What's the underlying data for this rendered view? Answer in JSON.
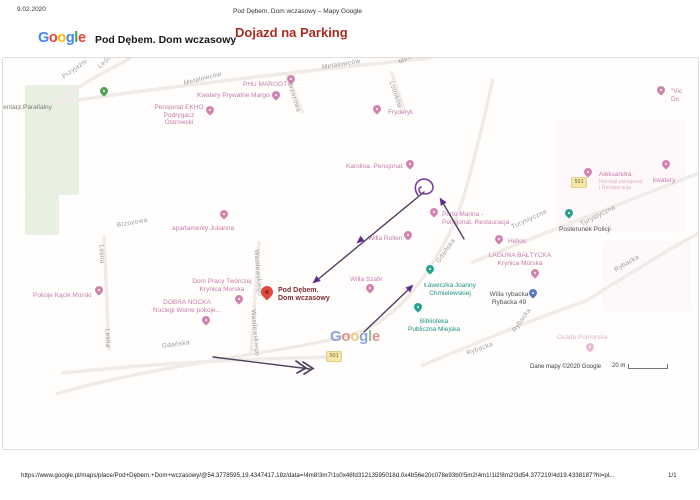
{
  "header": {
    "date": "9.02.2020",
    "doc_title": "Pod Dębem. Dom wczasowy – Mapy Google",
    "brand": "Google",
    "place_title": "Pod Dębem. Dom wczasowy",
    "heading": "Dojazd na Parking"
  },
  "google_letters": [
    {
      "ch": "G",
      "c": "#4285F4"
    },
    {
      "ch": "o",
      "c": "#EA4335"
    },
    {
      "ch": "o",
      "c": "#FBBC05"
    },
    {
      "ch": "g",
      "c": "#4285F4"
    },
    {
      "ch": "l",
      "c": "#34A853"
    },
    {
      "ch": "e",
      "c": "#EA4335"
    }
  ],
  "watermark_letters": [
    {
      "ch": "G",
      "c": "#6f8fd2"
    },
    {
      "ch": "o",
      "c": "#d77b72"
    },
    {
      "ch": "o",
      "c": "#e5c05c"
    },
    {
      "ch": "g",
      "c": "#6f8fd2"
    },
    {
      "ch": "l",
      "c": "#7fae7a"
    },
    {
      "ch": "e",
      "c": "#d77b72"
    }
  ],
  "map": {
    "attribution": "Dane mapy ©2020 Google",
    "scale_label": "20 m",
    "badge_label": "501",
    "badges": [
      {
        "x": 323,
        "y": 293
      },
      {
        "x": 568,
        "y": 119
      }
    ],
    "areas": [
      {
        "x": 22,
        "y": 27,
        "w": 54,
        "h": 110,
        "color": "#e5f0de",
        "op": 0.9
      },
      {
        "x": 22,
        "y": 135,
        "w": 34,
        "h": 42,
        "color": "#e5f0de",
        "op": 0.9
      },
      {
        "x": 553,
        "y": 63,
        "w": 130,
        "h": 110,
        "color": "#fdf2f7",
        "op": 0.5
      },
      {
        "x": 598,
        "y": 183,
        "w": 90,
        "h": 70,
        "color": "#fdf2f7",
        "op": 0.5
      }
    ],
    "roads": [
      "M53,336 C158,305 298,293 353,275 C398,260 428,213 450,168 C463,139 478,73 490,21",
      "M13,51 C118,35 258,17 428,0",
      "M468,205 C558,168 638,138 696,115",
      "M583,243 C628,215 663,193 696,175",
      "M418,308 C478,283 538,258 583,243",
      "M256,183 L248,295",
      "M101,178 L106,293",
      "M58,315 C158,305 258,300 338,299",
      "M283,15 L300,55",
      "M388,13 L402,55",
      "M38,53 C68,33 93,18 128,0"
    ],
    "streets": [
      {
        "t": "Przyjaźni",
        "x": 60,
        "y": 16,
        "r": -35
      },
      {
        "t": "Leśna",
        "x": 96,
        "y": 6,
        "r": -42
      },
      {
        "t": "Metalowców",
        "x": 181,
        "y": 22,
        "r": -14
      },
      {
        "t": "Metalowców",
        "x": 319,
        "y": 6,
        "r": -9
      },
      {
        "t": "Metalowców",
        "x": 396,
        "y": 1,
        "r": -25
      },
      {
        "t": "Brzozowa",
        "x": 286,
        "y": 21,
        "r": 72
      },
      {
        "t": "Lotników",
        "x": 388,
        "y": 20,
        "r": 72
      },
      {
        "t": "Brzozowa",
        "x": 114,
        "y": 164,
        "r": -10
      },
      {
        "t": "Leśna",
        "x": 98,
        "y": 183,
        "r": 88
      },
      {
        "t": "Leśna",
        "x": 104,
        "y": 267,
        "r": 88
      },
      {
        "t": "Wasilewskiego",
        "x": 253,
        "y": 188,
        "r": 85
      },
      {
        "t": "Wasilewskiego",
        "x": 250,
        "y": 248,
        "r": 85
      },
      {
        "t": "Gdańska",
        "x": 159,
        "y": 285,
        "r": -8
      },
      {
        "t": "Gdańska",
        "x": 435,
        "y": 201,
        "r": -55
      },
      {
        "t": "Turystyczna",
        "x": 509,
        "y": 166,
        "r": -25
      },
      {
        "t": "Turystyczna",
        "x": 578,
        "y": 163,
        "r": -27
      },
      {
        "t": "Rybacka",
        "x": 612,
        "y": 209,
        "r": -30
      },
      {
        "t": "Rybacka",
        "x": 511,
        "y": 270,
        "r": -55
      },
      {
        "t": "Rybacka",
        "x": 464,
        "y": 292,
        "r": -20
      }
    ],
    "pois": [
      {
        "lines": [
          "Cmentarz Parafialny"
        ],
        "cls": "greenlbl",
        "x": -10,
        "y": 46,
        "pin": {
          "t": "green",
          "x": 97,
          "y": 29
        }
      },
      {
        "lines": [
          "Pensjonat EKHO",
          "Podrygacz Ostrowski"
        ],
        "cls": "pink",
        "x": 146,
        "y": 46,
        "w": 60,
        "align": "center",
        "pin": {
          "t": "pink",
          "x": 203,
          "y": 48
        }
      },
      {
        "lines": [
          "PHU MARGOT"
        ],
        "cls": "pink",
        "x": 240,
        "y": 23,
        "pin": {
          "t": "pink",
          "x": 284,
          "y": 17
        }
      },
      {
        "lines": [
          "Kwatery Prywatne Margo"
        ],
        "cls": "pink",
        "x": 194,
        "y": 34,
        "pin": {
          "t": "pink",
          "x": 269,
          "y": 33
        }
      },
      {
        "lines": [
          "Fryderyk"
        ],
        "cls": "pink",
        "x": 385,
        "y": 51,
        "pin": {
          "t": "pink",
          "x": 370,
          "y": 47
        }
      },
      {
        "lines": [
          "\"Vic",
          "Do"
        ],
        "cls": "pink",
        "x": 668,
        "y": 30,
        "pin": {
          "t": "pink",
          "x": 654,
          "y": 28
        }
      },
      {
        "lines": [
          "Karolina. Pensjonat"
        ],
        "cls": "pink",
        "x": 343,
        "y": 105,
        "pin": {
          "t": "pink",
          "x": 403,
          "y": 102
        }
      },
      {
        "lines": [
          "apartamenty Julianna"
        ],
        "cls": "pink",
        "x": 169,
        "y": 167,
        "pin": {
          "t": "pink",
          "x": 217,
          "y": 152
        }
      },
      {
        "lines": [
          "Aleksandra"
        ],
        "cls": "pink",
        "x": 596,
        "y": 113,
        "sub": [
          "Noclegi pensjonat",
          "i Restauracja"
        ],
        "pin": {
          "t": "pink",
          "x": 581,
          "y": 110
        }
      },
      {
        "lines": [
          "kwatery"
        ],
        "cls": "pink",
        "x": 650,
        "y": 119,
        "pin": {
          "t": "pink",
          "x": 659,
          "y": 102
        }
      },
      {
        "lines": [
          "Dom Pracy Twórczej",
          "Krynica Morska"
        ],
        "cls": "pink",
        "x": 184,
        "y": 220,
        "w": 70,
        "align": "center",
        "pin": {
          "t": "pink",
          "x": 232,
          "y": 237
        }
      },
      {
        "lines": [
          "DOBRA NOCKA",
          "Noclegi Wolne pokoje..."
        ],
        "cls": "pink",
        "x": 144,
        "y": 241,
        "w": 80,
        "align": "center",
        "pin": {
          "t": "pink",
          "x": 199,
          "y": 258
        }
      },
      {
        "lines": [
          "Pokoje Kącik Morski"
        ],
        "cls": "pink",
        "x": 30,
        "y": 234,
        "pin": {
          "t": "pink",
          "x": 92,
          "y": 228
        }
      },
      {
        "lines": [
          "Willa Szafir"
        ],
        "cls": "pink",
        "x": 347,
        "y": 218,
        "pin": {
          "t": "pink",
          "x": 363,
          "y": 226
        }
      },
      {
        "lines": [
          "Willa Rollen"
        ],
        "cls": "pink",
        "x": 365,
        "y": 177,
        "pin": {
          "t": "pink",
          "x": 401,
          "y": 173
        }
      },
      {
        "lines": [
          "Porto Marina -",
          "Pensjonat, Restauracja"
        ],
        "cls": "pink",
        "x": 439,
        "y": 153,
        "pin": {
          "t": "pink",
          "x": 427,
          "y": 150
        }
      },
      {
        "lines": [
          "Helios"
        ],
        "cls": "pink",
        "x": 505,
        "y": 180,
        "pin": {
          "t": "pink",
          "x": 492,
          "y": 177
        }
      },
      {
        "lines": [
          "LAGUNA BAŁTYCKA",
          "Krynica Morska"
        ],
        "cls": "pink",
        "x": 484,
        "y": 194,
        "w": 66,
        "align": "center",
        "pin": {
          "t": "pink",
          "x": 528,
          "y": 211
        }
      },
      {
        "lines": [
          "Osada Pomorska"
        ],
        "cls": "pinklight",
        "x": 554,
        "y": 276,
        "pin": {
          "t": "pinklight",
          "x": 583,
          "y": 285
        }
      },
      {
        "lines": [
          "Ławeczka Joanny",
          "Chmielewskiej"
        ],
        "cls": "teal",
        "x": 416,
        "y": 224,
        "w": 62,
        "align": "center",
        "pin": {
          "t": "teal",
          "x": 423,
          "y": 207
        }
      },
      {
        "lines": [
          "Biblioteka",
          "Publiczna Miejska"
        ],
        "cls": "teal",
        "x": 401,
        "y": 260,
        "w": 60,
        "align": "center",
        "pin": {
          "t": "teal",
          "x": 411,
          "y": 245
        }
      },
      {
        "lines": [
          "Posterunek Policji"
        ],
        "cls": "dark",
        "x": 556,
        "y": 168,
        "pin": {
          "t": "teal",
          "x": 562,
          "y": 151
        }
      },
      {
        "lines": [
          "Willa rybacka",
          "Rybacka 49"
        ],
        "cls": "dark",
        "x": 482,
        "y": 233,
        "w": 48,
        "align": "center",
        "pin": {
          "t": "blue",
          "x": 526,
          "y": 231
        }
      },
      {
        "lines": [
          "Pod Dębem.",
          "Dom wczasowy"
        ],
        "cls": "placered",
        "x": 275,
        "y": 229,
        "pin": {
          "t": "red",
          "x": 258,
          "y": 228
        }
      }
    ],
    "annotation": {
      "line_color": "#4b4260",
      "head_color": "#4a2f9b",
      "head_stroke": "#933b86",
      "curl_color": "#7a3da0",
      "lines": [
        "M210,299 L307,311",
        "M361,274 L406,231",
        "M461,181 L440,145",
        "M421,134 L313,223"
      ],
      "chevrons": [
        "M300,304 L310,310.5 L301,316",
        "M293,303 L303,310 L294,315"
      ],
      "triangles": [
        "M410,227 L407.1,234 L402.9,229.6 Z",
        "M437,140 L443.2,144.5 L438,147.5 Z",
        "M310,225 L313.5,218.2 L317.3,222.8 Z",
        "M354,185 L357.5,178.2 L361.3,182.8 Z"
      ],
      "curl": "M415,137 C408,128 416,118 425,122 C433,126 431,136 422,136 C416,136 414,131 418,129"
    }
  },
  "footer": {
    "url": "https://www.google.pl/maps/place/Pod+Dębem.+Dom+wczasowy/@54.3778595,19.4347417,18z/data=!4m8!3m7!1s0x46fd31213595018d.0x4b56e20c078e93b0!5m2!4m1!1i2!8m2!3d54.377219!4d19.4338187?hl=pl...",
    "page": "1/1"
  }
}
